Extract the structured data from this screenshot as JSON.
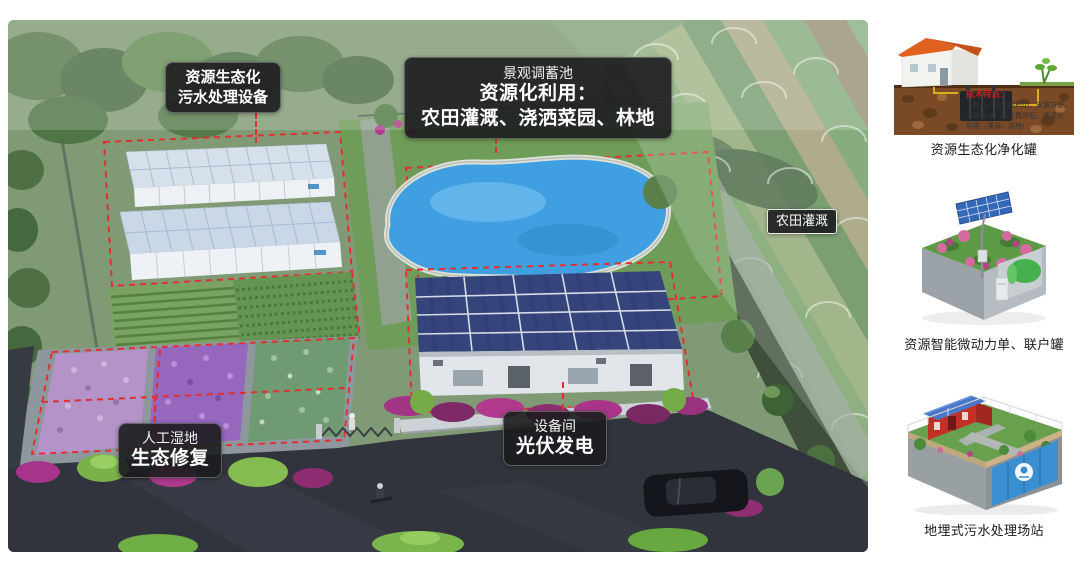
{
  "main_view": {
    "callouts": {
      "treatment_equipment": {
        "line1": "资源生态化",
        "line2": "污水处理设备"
      },
      "landscape_pond": {
        "line1": "景观调蓄池",
        "line2": "资源化利用：",
        "line3": "农田灌溉、浇洒菜园、林地"
      },
      "farmland_irrigation": {
        "label": "农田灌溉"
      },
      "wetland": {
        "line1": "人工湿地",
        "line2": "生态修复"
      },
      "equipment_room": {
        "line1": "设备间",
        "line2": "光伏发电"
      }
    }
  },
  "sidebar": {
    "cards": [
      {
        "caption": "资源生态化净化罐",
        "tech_title": "技术特点：",
        "tech_lines": [
          "无能耗、占地面积小、安装方便、",
          "无需运维、投资费用低、资源化",
          "利用（灌溉、浇地）"
        ]
      },
      {
        "caption": "资源智能微动力单、联户罐"
      },
      {
        "caption": "地埋式污水处理场站"
      }
    ]
  },
  "colors": {
    "annotation_red": "#e23030",
    "callout_bg": "#1d1d1f",
    "pond_blue": "#3f9fe0",
    "solar_roof_blue": "#35457c",
    "tech_title_red": "#c42222"
  }
}
